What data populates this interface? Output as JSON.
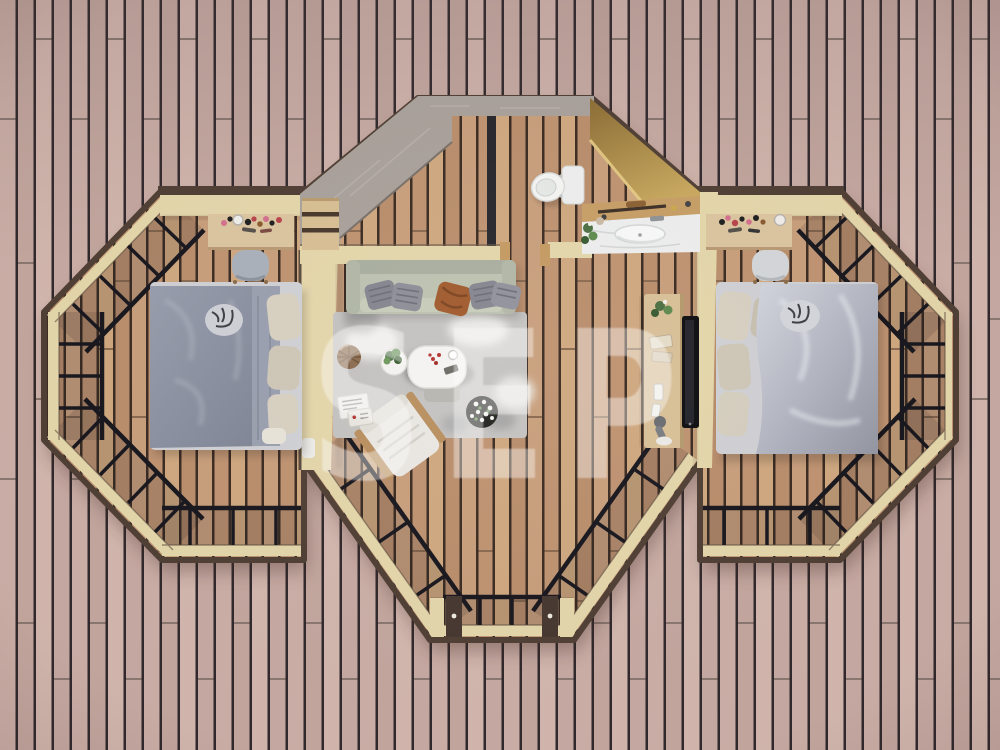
{
  "meta": {
    "scene": "glamping-pod-top-view-3d-floor-plan",
    "view": "top-down",
    "watermark_text": "SEP"
  },
  "palette": {
    "deck_a": "#cbafa7",
    "deck_b": "#c3a79f",
    "deck_c": "#d2b7ae",
    "deck_d": "#c6a9a2",
    "deck_gap": "#2f282b",
    "floor_a": "#c89f7c",
    "floor_b": "#bf9371",
    "floor_c": "#cfa87f",
    "floor_d": "#b98e6c",
    "floor_gap": "#3a2b22",
    "wall_cap": "#e5d7ab",
    "wall_cap_deep": "#d6c691",
    "wall_edge": "#4e3e33",
    "stone": "#a9a19b",
    "stone_dark": "#8e8680",
    "gold_light": "#c9a95e",
    "gold_dark": "#8a6c34",
    "frame": "#17161d",
    "glass_tint": "rgba(25,22,30,0.13)",
    "bed_left_duvet": "#8e94a5",
    "bed_right_duvet": "#b7bbc7",
    "bed_base": "#d0d1d5",
    "pillow": "#d8d1c2",
    "sofa": "#bcc2b1",
    "sofa_cushion": "#83848e",
    "leather": "#a05a2c",
    "rug": "#c4c3c1",
    "rug_dark": "#8b8c8e",
    "white": "#f5f4f2",
    "wood_light": "#dcc6a0",
    "wood_mid": "#c49a62",
    "tv": "#0d0d11",
    "chair": "#aab1bb",
    "plant": "#4a7042",
    "watermark": "#ffffff"
  },
  "structure": {
    "shape": "octagonal-center-with-two-hex-wings",
    "glazing": "black-framed-glass-walls",
    "decking": "vertical-wood-plank-deck",
    "entry": "stone-clad-vestibule-top-left",
    "patio_doors": "double-sliding-doors-bottom-center"
  },
  "rooms": [
    {
      "name": "left-bedroom",
      "items": [
        "double-bed",
        "gray-duvet",
        "beige-pillows",
        "zebra-cushion",
        "makeup-desk",
        "desk-chair",
        "shelf-unit"
      ]
    },
    {
      "name": "living-room",
      "items": [
        "sofa",
        "striped-cushions",
        "leather-cushion",
        "area-rug",
        "coffee-table",
        "side-table-plant",
        "rattan-pouf",
        "lounge-chair",
        "flower-planter",
        "magazines",
        "tv-console",
        "wall-tv"
      ]
    },
    {
      "name": "entry-vestibule",
      "items": [
        "stone-walls",
        "pocket-door",
        "threshold-posts"
      ]
    },
    {
      "name": "bathroom",
      "items": [
        "toilet",
        "gold-feature-wall",
        "wood-shelf",
        "towel-rail",
        "marble-vanity",
        "sink",
        "plant"
      ]
    },
    {
      "name": "right-bedroom",
      "items": [
        "double-bed",
        "silver-duvet",
        "beige-pillows",
        "zebra-cushion",
        "makeup-desk",
        "desk-chair"
      ]
    }
  ]
}
